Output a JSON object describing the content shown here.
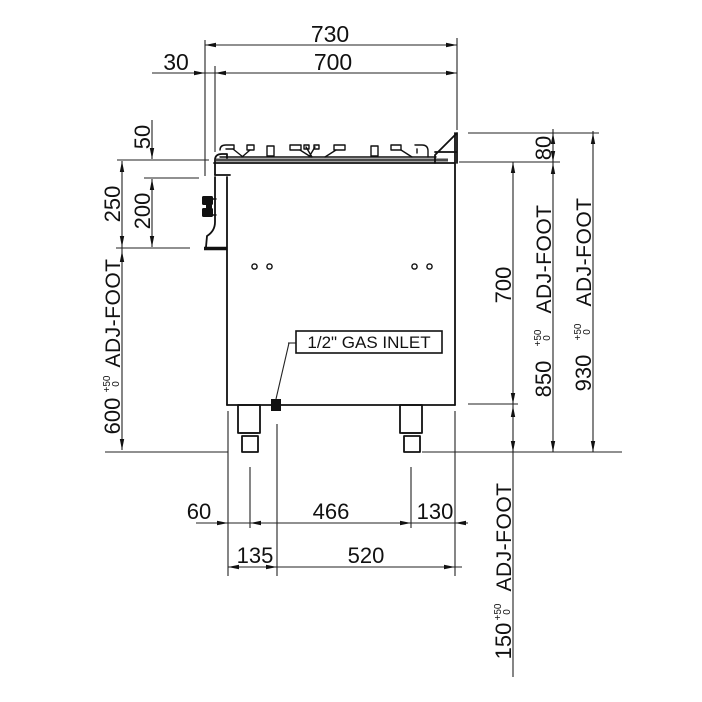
{
  "drawing": {
    "gas_inlet_label": "1/2\" GAS INLET",
    "adj_foot_label": "ADJ-FOOT",
    "tolerance_upper": "+50",
    "tolerance_lower": "0",
    "dims": {
      "depth_overall": "730",
      "depth_body": "700",
      "knob_offset": "30",
      "pan_support_height": "50",
      "worktop_to_panel_bottom": "250",
      "panel_height": "200",
      "panel_bottom_to_floor": "600",
      "upstand_height": "80",
      "body_height": "700",
      "worktop_height": "850",
      "overall_height": "930",
      "foot_adjust": "150",
      "front_to_leg_center": "60",
      "leg_centers": "466",
      "leg_center_to_back": "130",
      "front_to_gas_inlet": "135",
      "gas_inlet_to_back": "520"
    }
  }
}
